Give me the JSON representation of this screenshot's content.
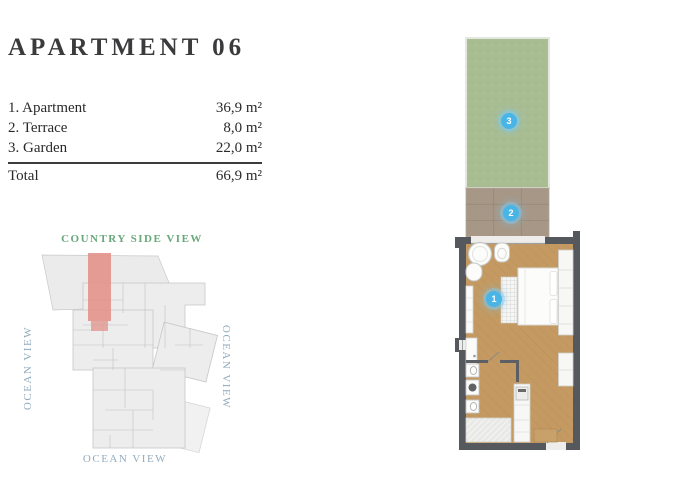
{
  "page": {
    "title": "APARTMENT 06"
  },
  "legend": {
    "rows": [
      {
        "label": "1. Apartment",
        "value": "36,9 m²"
      },
      {
        "label": "2. Terrace",
        "value": "8,0 m²"
      },
      {
        "label": "3. Garden",
        "value": "22,0 m²"
      }
    ],
    "total": {
      "label": "Total",
      "value": "66,9 m²"
    }
  },
  "site_plan": {
    "top_label": "COUNTRY SIDE VIEW",
    "left_label": "OCEAN VIEW",
    "right_label": "OCEAN VIEW",
    "bottom_label": "OCEAN VIEW",
    "colors": {
      "view_green": "#69a87b",
      "view_blue": "#92abbd",
      "highlight": "#e2928b",
      "building": "#ededed"
    }
  },
  "floor_plan": {
    "badges": [
      {
        "number": "1",
        "area": "Apartment"
      },
      {
        "number": "2",
        "area": "Terrace"
      },
      {
        "number": "3",
        "area": "Garden"
      }
    ],
    "colors": {
      "badge_blue": "#49b5e7",
      "wall": "#55595d",
      "wood_floor": "#c49a62",
      "garden_green": "#a9bd92",
      "terrace_tile": "#a79786"
    }
  }
}
